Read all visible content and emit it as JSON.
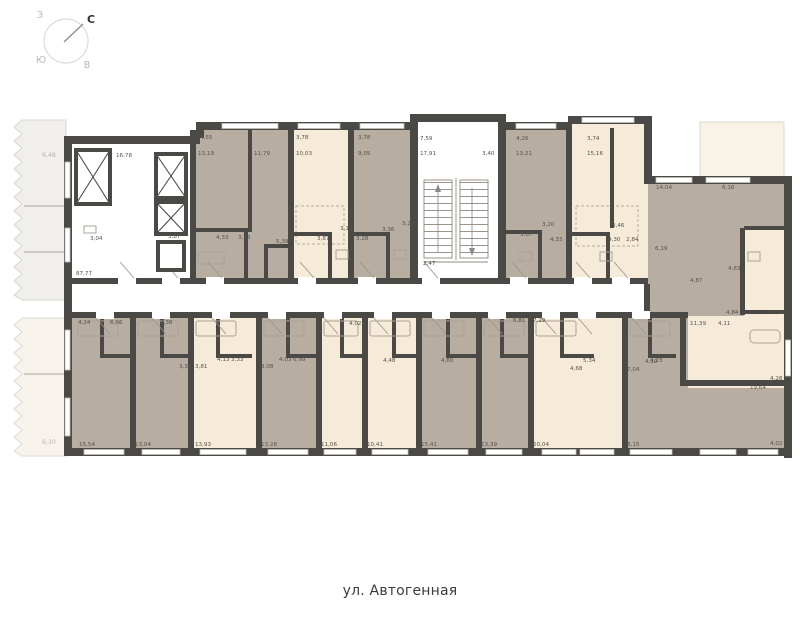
{
  "compass": {
    "north": "С",
    "south": "Ю",
    "west": "З",
    "east": "В"
  },
  "street": {
    "label": "ул. Автогенная"
  },
  "plan": {
    "colors": {
      "wall": "#4a4946",
      "room_tan": "#b7ada0",
      "room_cream": "#f6ead9",
      "balcony": "#f0efec"
    },
    "labels": [
      {
        "t": "16,78",
        "x": 116,
        "y": 157
      },
      {
        "t": "3,04",
        "x": 90,
        "y": 240
      },
      {
        "t": "87,77",
        "x": 76,
        "y": 275
      },
      {
        "t": "3,87",
        "x": 168,
        "y": 238
      },
      {
        "t": "6,48",
        "x": 42,
        "y": 157,
        "m": 1
      },
      {
        "t": "6,30",
        "x": 42,
        "y": 444,
        "m": 1
      },
      {
        "t": "4,55",
        "x": 200,
        "y": 139
      },
      {
        "t": "13,19",
        "x": 198,
        "y": 155
      },
      {
        "t": "11,79",
        "x": 254,
        "y": 155
      },
      {
        "t": "4,33",
        "x": 216,
        "y": 239
      },
      {
        "t": "3,43",
        "x": 238,
        "y": 239
      },
      {
        "t": "5,39",
        "x": 276,
        "y": 243
      },
      {
        "t": "3,78",
        "x": 296,
        "y": 139
      },
      {
        "t": "10,03",
        "x": 296,
        "y": 155
      },
      {
        "t": "3,87",
        "x": 317,
        "y": 240
      },
      {
        "t": "3,19",
        "x": 340,
        "y": 230
      },
      {
        "t": "3,78",
        "x": 358,
        "y": 139
      },
      {
        "t": "9,05",
        "x": 358,
        "y": 155
      },
      {
        "t": "3,28",
        "x": 356,
        "y": 240
      },
      {
        "t": "3,36",
        "x": 382,
        "y": 231
      },
      {
        "t": "3,20",
        "x": 402,
        "y": 225
      },
      {
        "t": "7,59",
        "x": 420,
        "y": 140
      },
      {
        "t": "17,91",
        "x": 420,
        "y": 155
      },
      {
        "t": "3,40",
        "x": 482,
        "y": 155
      },
      {
        "t": "2,47",
        "x": 423,
        "y": 265
      },
      {
        "t": "4,26",
        "x": 516,
        "y": 140
      },
      {
        "t": "13,21",
        "x": 516,
        "y": 155
      },
      {
        "t": "3,20",
        "x": 542,
        "y": 226
      },
      {
        "t": "3,67",
        "x": 520,
        "y": 236
      },
      {
        "t": "4,33",
        "x": 550,
        "y": 241
      },
      {
        "t": "3,74",
        "x": 587,
        "y": 140
      },
      {
        "t": "15,16",
        "x": 587,
        "y": 155
      },
      {
        "t": "3,46",
        "x": 612,
        "y": 227
      },
      {
        "t": "4,30",
        "x": 608,
        "y": 241
      },
      {
        "t": "2,84",
        "x": 626,
        "y": 241
      },
      {
        "t": "14,04",
        "x": 656,
        "y": 189
      },
      {
        "t": "6,16",
        "x": 722,
        "y": 189
      },
      {
        "t": "6,19",
        "x": 655,
        "y": 250
      },
      {
        "t": "4,63",
        "x": 728,
        "y": 270
      },
      {
        "t": "4,87",
        "x": 690,
        "y": 282
      },
      {
        "t": "4,84",
        "x": 726,
        "y": 314
      },
      {
        "t": "9,82",
        "x": 772,
        "y": 314
      },
      {
        "t": "11,39",
        "x": 690,
        "y": 325
      },
      {
        "t": "4,11",
        "x": 718,
        "y": 325
      },
      {
        "t": "4,23",
        "x": 650,
        "y": 362
      },
      {
        "t": "4,28",
        "x": 770,
        "y": 380
      },
      {
        "t": "19,64",
        "x": 750,
        "y": 389
      },
      {
        "t": "4,02",
        "x": 770,
        "y": 445
      },
      {
        "t": "4,24",
        "x": 78,
        "y": 324
      },
      {
        "t": "6,66",
        "x": 110,
        "y": 324
      },
      {
        "t": "3,38",
        "x": 160,
        "y": 324
      },
      {
        "t": "3,30",
        "x": 179,
        "y": 368
      },
      {
        "t": "3,81",
        "x": 195,
        "y": 368
      },
      {
        "t": "4,13",
        "x": 217,
        "y": 361
      },
      {
        "t": "3,33",
        "x": 231,
        "y": 361
      },
      {
        "t": "3,08",
        "x": 261,
        "y": 368
      },
      {
        "t": "4,03",
        "x": 279,
        "y": 361
      },
      {
        "t": "6,99",
        "x": 293,
        "y": 361
      },
      {
        "t": "4,02",
        "x": 349,
        "y": 325
      },
      {
        "t": "4,48",
        "x": 383,
        "y": 362
      },
      {
        "t": "4,60",
        "x": 441,
        "y": 362
      },
      {
        "t": "6,81",
        "x": 513,
        "y": 322
      },
      {
        "t": "7,29",
        "x": 533,
        "y": 322
      },
      {
        "t": "5,34",
        "x": 583,
        "y": 362
      },
      {
        "t": "4,68",
        "x": 570,
        "y": 370
      },
      {
        "t": "4,19",
        "x": 645,
        "y": 363
      },
      {
        "t": "7,04",
        "x": 627,
        "y": 371
      },
      {
        "t": "15,54",
        "x": 79,
        "y": 446
      },
      {
        "t": "13,04",
        "x": 135,
        "y": 446
      },
      {
        "t": "13,93",
        "x": 195,
        "y": 446
      },
      {
        "t": "13,28",
        "x": 261,
        "y": 446
      },
      {
        "t": "11,06",
        "x": 321,
        "y": 446
      },
      {
        "t": "10,41",
        "x": 367,
        "y": 446
      },
      {
        "t": "15,41",
        "x": 421,
        "y": 446
      },
      {
        "t": "13,39",
        "x": 481,
        "y": 446
      },
      {
        "t": "20,04",
        "x": 533,
        "y": 446
      },
      {
        "t": "8,15",
        "x": 627,
        "y": 446
      }
    ]
  }
}
